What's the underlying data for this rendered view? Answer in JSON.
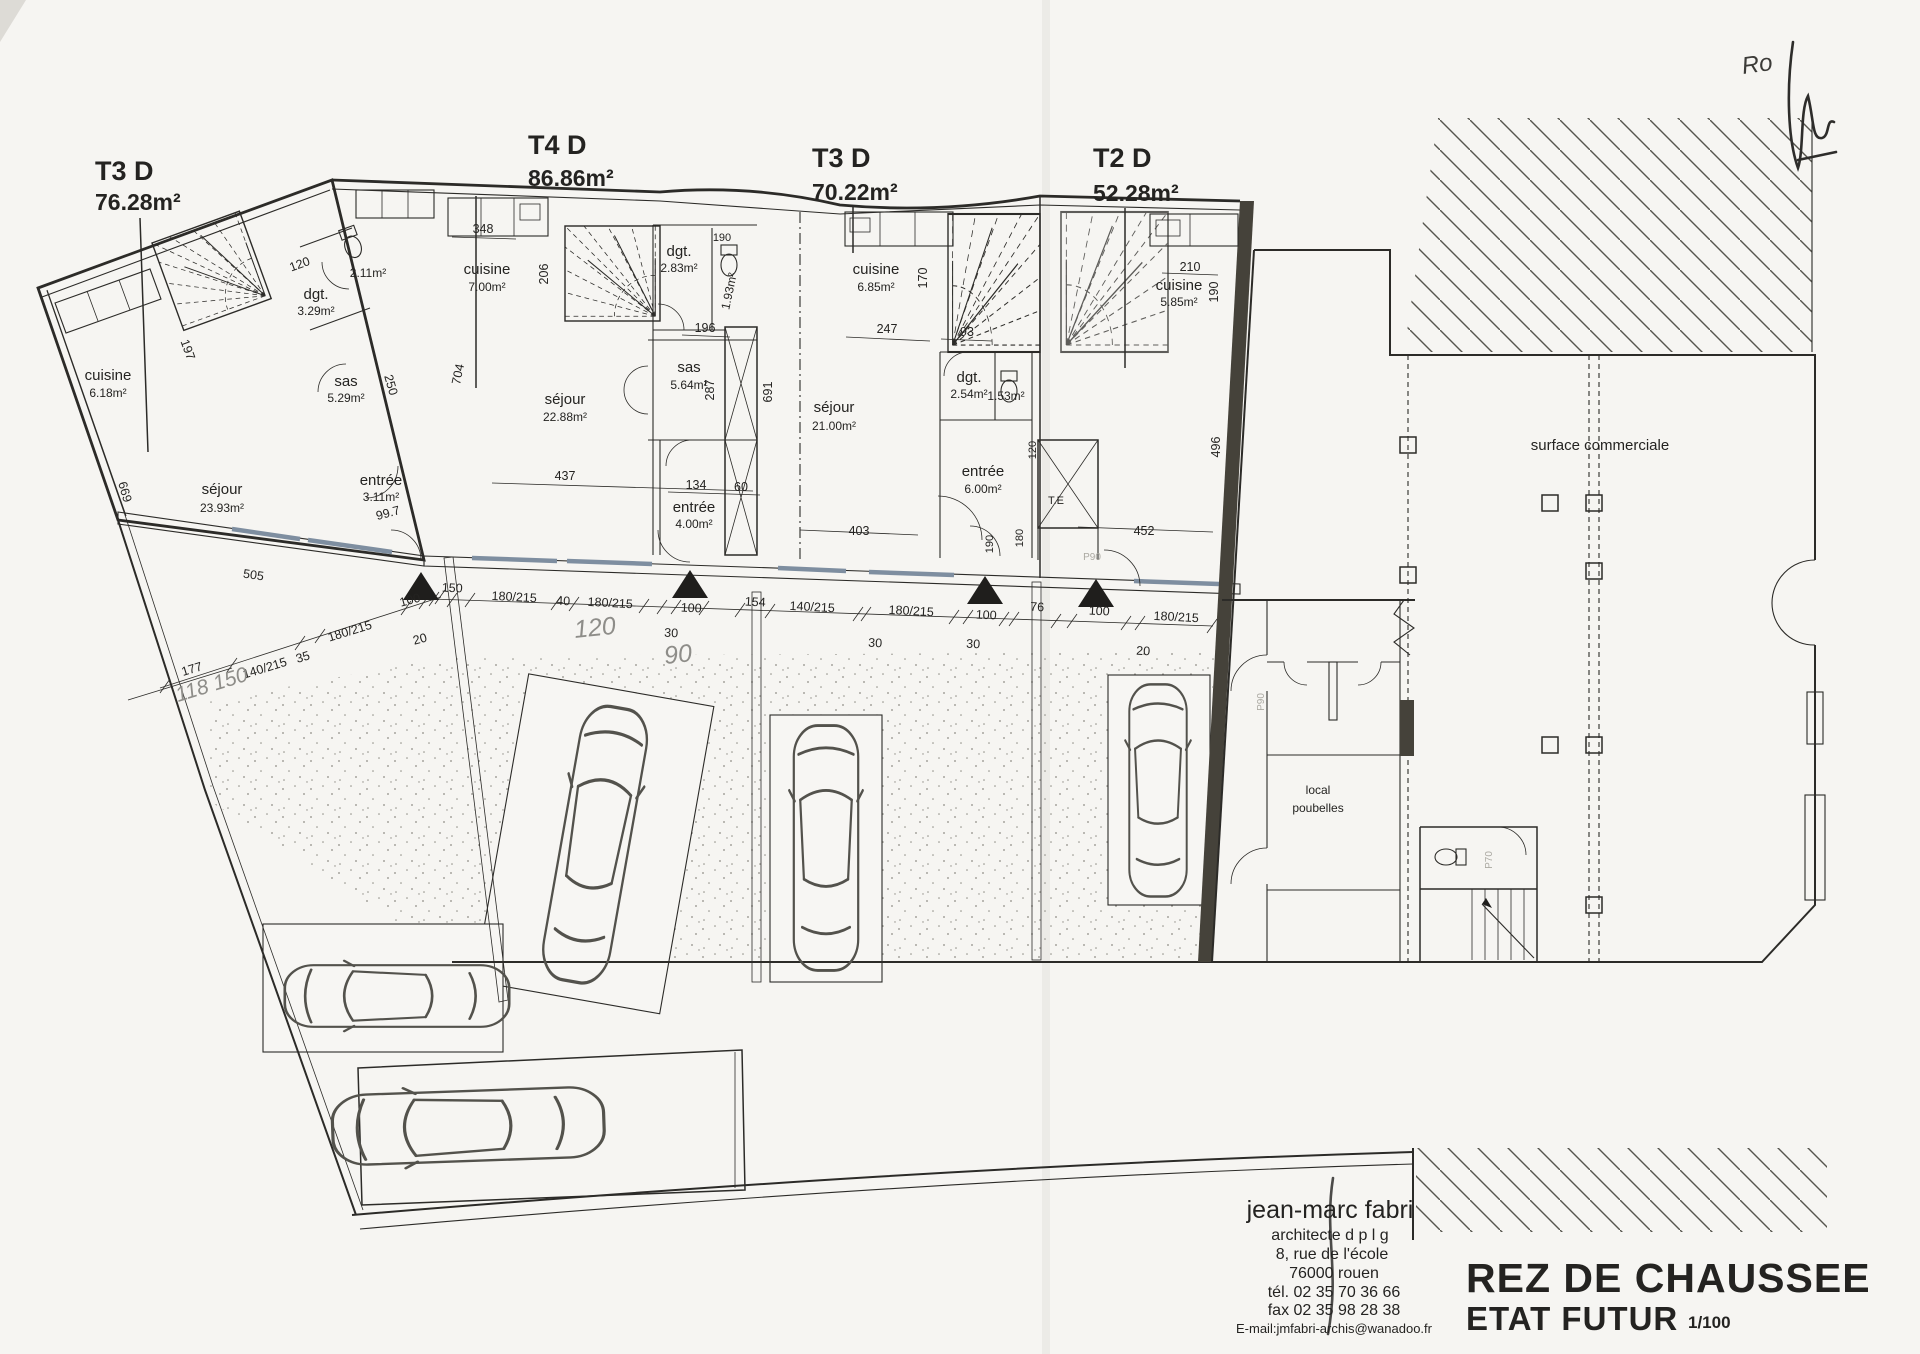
{
  "page": {
    "title": "REZ DE CHAUSSEE",
    "subtitle": "ETAT FUTUR",
    "scale": "1/100"
  },
  "architect": {
    "name": "jean-marc fabri",
    "title": "architecte d p l g",
    "address1": "8, rue de l'école",
    "address2": "76000 rouen",
    "tel": "tél. 02 35 70 36 66",
    "fax": "fax 02 35 98 28 38",
    "email": "E-mail:jmfabri-archis@wanadoo.fr"
  },
  "units": [
    {
      "code": "T3 D",
      "surface": "76.28m²",
      "rooms": {
        "cuisine": {
          "name": "cuisine",
          "area": "6.18m²"
        },
        "sejour": {
          "name": "séjour",
          "area": "23.93m²"
        },
        "sas": {
          "name": "sas",
          "area": "5.29m²"
        },
        "dgt": {
          "name": "dgt.",
          "area": "3.29m²"
        },
        "wc": {
          "area": "2.11m²"
        },
        "entree": {
          "name": "entrée",
          "area": "3.11m²"
        }
      },
      "dims": {
        "d120": "120",
        "d197": "197",
        "d669": "669",
        "d250": "250",
        "d505": "505",
        "d997": "99.7"
      }
    },
    {
      "code": "T4 D",
      "surface": "86.86m²",
      "rooms": {
        "cuisine": {
          "name": "cuisine",
          "area": "7.00m²"
        },
        "sejour": {
          "name": "séjour",
          "area": "22.88m²"
        },
        "sas": {
          "name": "sas",
          "area": "5.64m²"
        },
        "dgt": {
          "name": "dgt.",
          "area": "2.83m²"
        },
        "wc": {
          "area": "1.93m²"
        },
        "entree": {
          "name": "entrée",
          "area": "4.00m²"
        }
      },
      "dims": {
        "d348": "348",
        "d206": "206",
        "d704": "704",
        "d190": "190",
        "d196": "196",
        "d287": "287",
        "d691": "691",
        "d437": "437",
        "d134": "134",
        "d60": "60"
      }
    },
    {
      "code": "T3 D",
      "surface": "70.22m²",
      "rooms": {
        "cuisine": {
          "name": "cuisine",
          "area": "6.85m²"
        },
        "sejour": {
          "name": "séjour",
          "area": "21.00m²"
        },
        "dgt": {
          "name": "dgt.",
          "area": "2.54m²"
        },
        "wc": {
          "area": "1.53m²"
        },
        "entree": {
          "name": "entrée",
          "area": "6.00m²"
        }
      },
      "dims": {
        "d170": "170",
        "d247": "247",
        "d93": "93",
        "d403": "403",
        "d190": "190",
        "d180": "180",
        "d120": "120"
      }
    },
    {
      "code": "T2 D",
      "surface": "52.28m²",
      "rooms": {
        "cuisine": {
          "name": "cuisine",
          "area": "5.85m²"
        }
      },
      "dims": {
        "d210": "210",
        "d190": "190",
        "d496": "496",
        "d452": "452"
      }
    }
  ],
  "commercial": {
    "label": "surface commerciale"
  },
  "services": {
    "bins1": "local",
    "bins2": "poubelles",
    "elevator": "T.E"
  },
  "door_tags": {
    "p90": "P90",
    "p70": "P70"
  },
  "facade_dims": {
    "f1": "140/215",
    "f2": "35",
    "f3": "180/215",
    "f4": "100",
    "f5": "20",
    "f6": "150",
    "f7": "180/215",
    "f8": "40",
    "f9": "180/215",
    "f10": "100",
    "f11": "30",
    "f12": "154",
    "f13": "140/215",
    "f14": "180/215",
    "f15": "100",
    "f16": "30",
    "f17": "30",
    "f18": "76",
    "f19": "100",
    "f20": "180/215",
    "f21": "20",
    "f22": "177"
  },
  "handwritten": {
    "h1": "120",
    "h2": "90",
    "h3": "118 150",
    "sig": "Ro"
  }
}
